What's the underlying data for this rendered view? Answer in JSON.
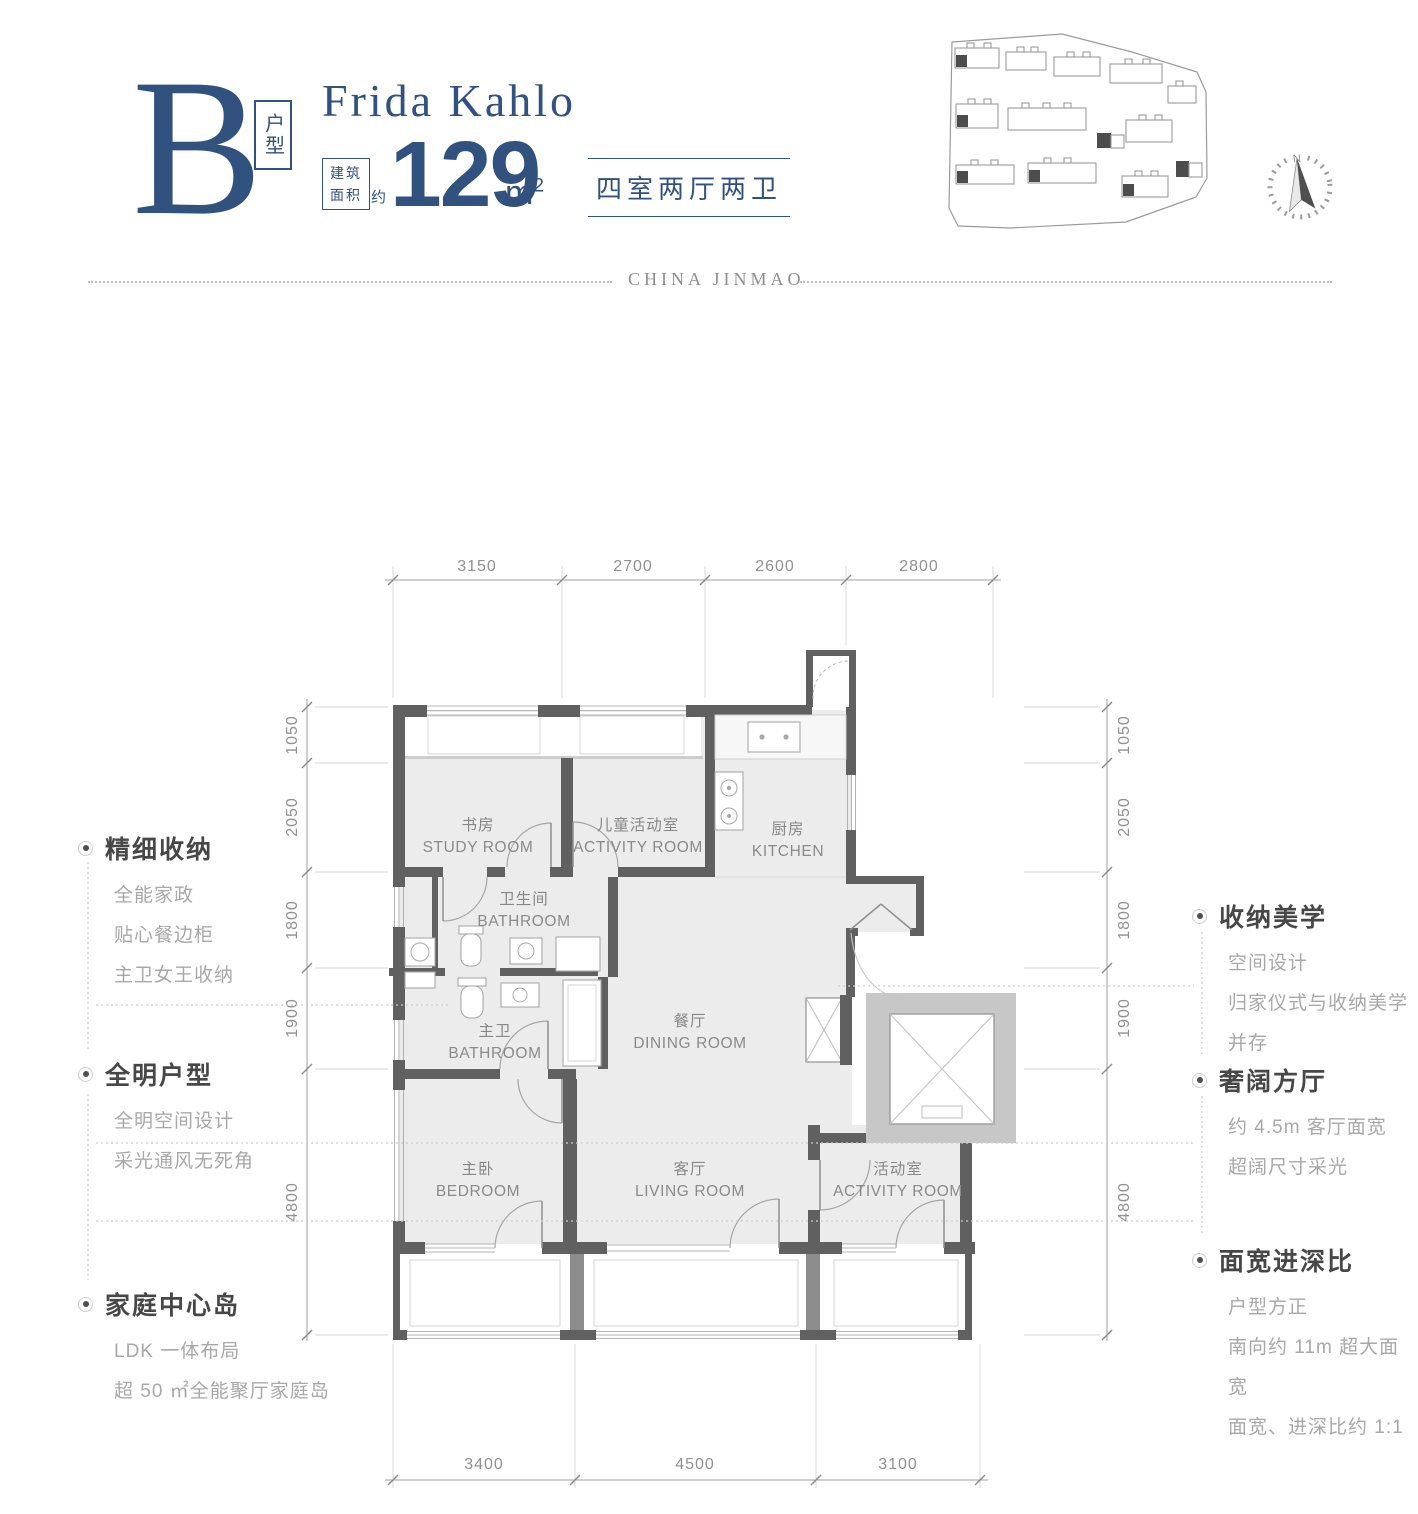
{
  "header": {
    "unit_letter": "B",
    "unit_type_label": "户型",
    "project_title": "Frida Kahlo",
    "area_box_top": "建筑",
    "area_box_bottom": "面积",
    "area_approx": "约",
    "area_value": "129",
    "area_unit": "m",
    "area_unit_sup": "2",
    "layout_summary": "四室两厅两卫",
    "brand": "CHINA JINMAO"
  },
  "site_plan": {
    "compass_label": "N"
  },
  "plan": {
    "rooms": [
      {
        "id": "study",
        "zh": "书房",
        "en": "STUDY ROOM"
      },
      {
        "id": "kids-activity",
        "zh": "儿童活动室",
        "en": "ACTIVITY ROOM"
      },
      {
        "id": "kitchen",
        "zh": "厨房",
        "en": "KITCHEN"
      },
      {
        "id": "bathroom",
        "zh": "卫生间",
        "en": "BATHROOM"
      },
      {
        "id": "master-bathroom",
        "zh": "主卫",
        "en": "BATHROOM"
      },
      {
        "id": "dining",
        "zh": "餐厅",
        "en": "DINING ROOM"
      },
      {
        "id": "bedroom",
        "zh": "主卧",
        "en": "BEDROOM"
      },
      {
        "id": "living",
        "zh": "客厅",
        "en": "LIVING ROOM"
      },
      {
        "id": "activity",
        "zh": "活动室",
        "en": "ACTIVITY ROOM"
      }
    ],
    "dims": {
      "top": [
        "3150",
        "2700",
        "2600",
        "2800"
      ],
      "bottom": [
        "3400",
        "4500",
        "3100"
      ],
      "left": [
        "1050",
        "2050",
        "1800",
        "1900",
        "4800"
      ],
      "right": [
        "1050",
        "2050",
        "1800",
        "1900",
        "4800"
      ]
    }
  },
  "annotations": {
    "left": [
      {
        "title": "精细收纳",
        "lines": [
          "全能家政",
          "贴心餐边柜",
          "主卫女王收纳"
        ]
      },
      {
        "title": "全明户型",
        "lines": [
          "全明空间设计",
          "采光通风无死角"
        ]
      },
      {
        "title": "家庭中心岛",
        "lines": [
          "LDK 一体布局",
          "超 50 ㎡全能聚厅家庭岛"
        ]
      }
    ],
    "right": [
      {
        "title": "收纳美学",
        "lines": [
          "空间设计",
          "归家仪式与收纳美学并存"
        ]
      },
      {
        "title": "奢阔方厅",
        "lines": [
          "约 4.5m 客厅面宽",
          "超阔尺寸采光"
        ]
      },
      {
        "title": "面宽进深比",
        "lines": [
          "户型方正",
          "南向约 11m 超大面宽",
          "面宽、进深比约 1:1"
        ]
      }
    ]
  },
  "colors": {
    "navy": "#31517e",
    "wall": "#606060",
    "floor": "#ececec",
    "core_gray": "#c7c7c7",
    "dim_text": "#909090",
    "title_text": "#474747",
    "body_text": "#a8a8a8"
  }
}
